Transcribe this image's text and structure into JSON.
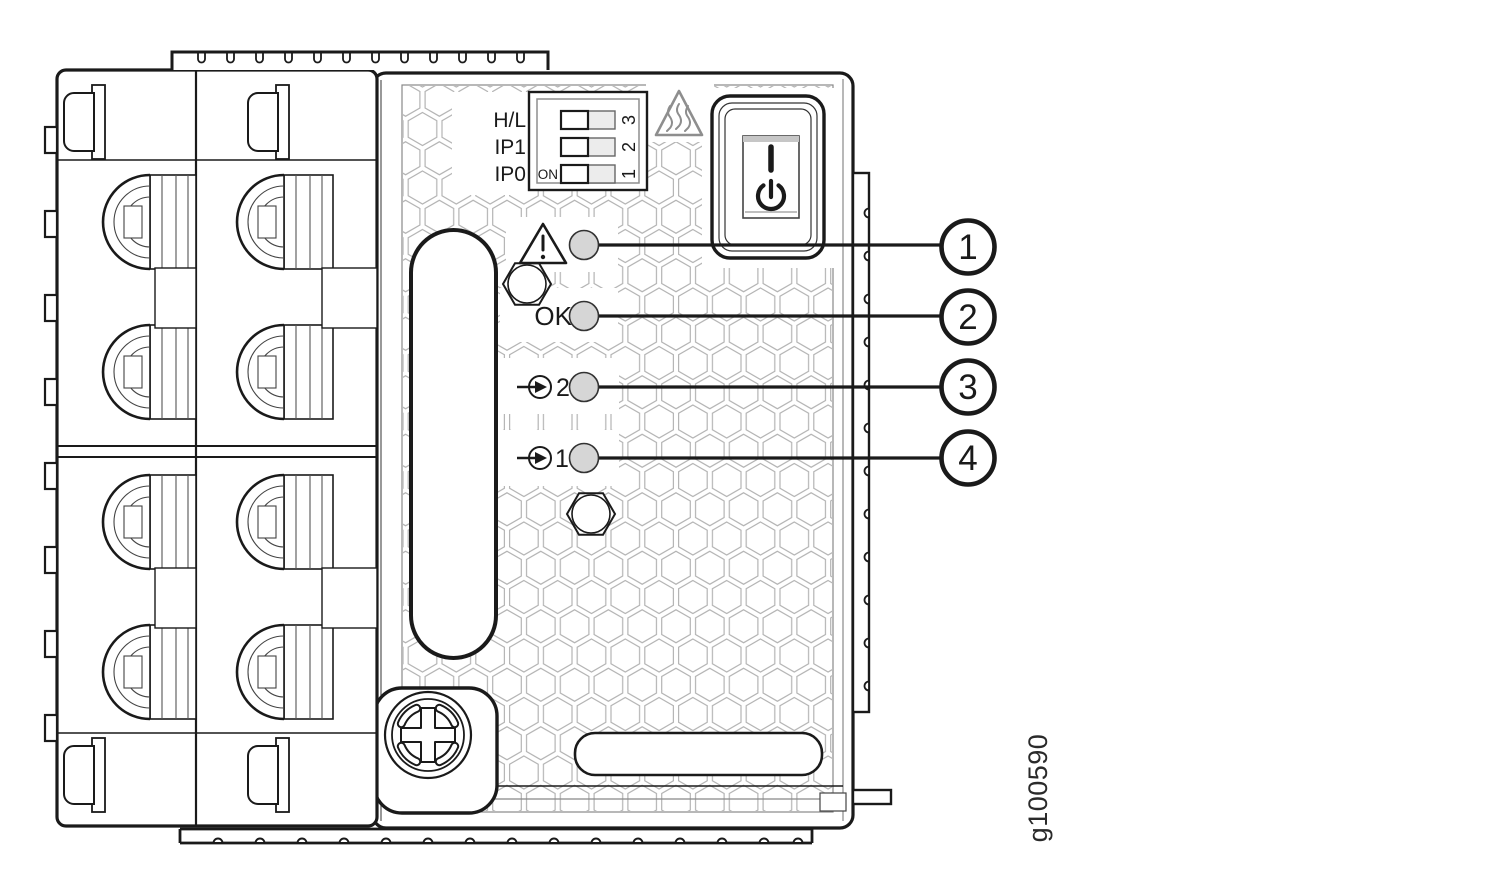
{
  "figure": {
    "id": "g100590"
  },
  "dip_switch": {
    "row_labels": [
      "H/L",
      "IP1",
      "IP0"
    ],
    "on_label": "ON",
    "position_numbers": [
      "3",
      "2",
      "1"
    ],
    "rows": 3
  },
  "power_switch": {
    "on_symbol": "I",
    "standby_symbol": "power-standby",
    "type": "rocker"
  },
  "icons": {
    "hot_surface": "hot-surface-warning-triangle",
    "warning": "warning-triangle-exclamation",
    "input": "arrow-into-circle"
  },
  "indicators": [
    {
      "icon": "warning-triangle",
      "label": "",
      "callout": "1"
    },
    {
      "icon": "none",
      "label": "OK",
      "callout": "2"
    },
    {
      "icon": "input-arrow",
      "label": "2",
      "callout": "3"
    },
    {
      "icon": "input-arrow",
      "label": "1",
      "callout": "4"
    }
  ],
  "colors": {
    "line": "#1a1a1a",
    "gray_trim": "#8e8e8e",
    "hex_pattern": "#b4b4b4",
    "led_fill": "#d6d6d6",
    "switch_band": "#c6c6c6",
    "background": "#ffffff"
  }
}
